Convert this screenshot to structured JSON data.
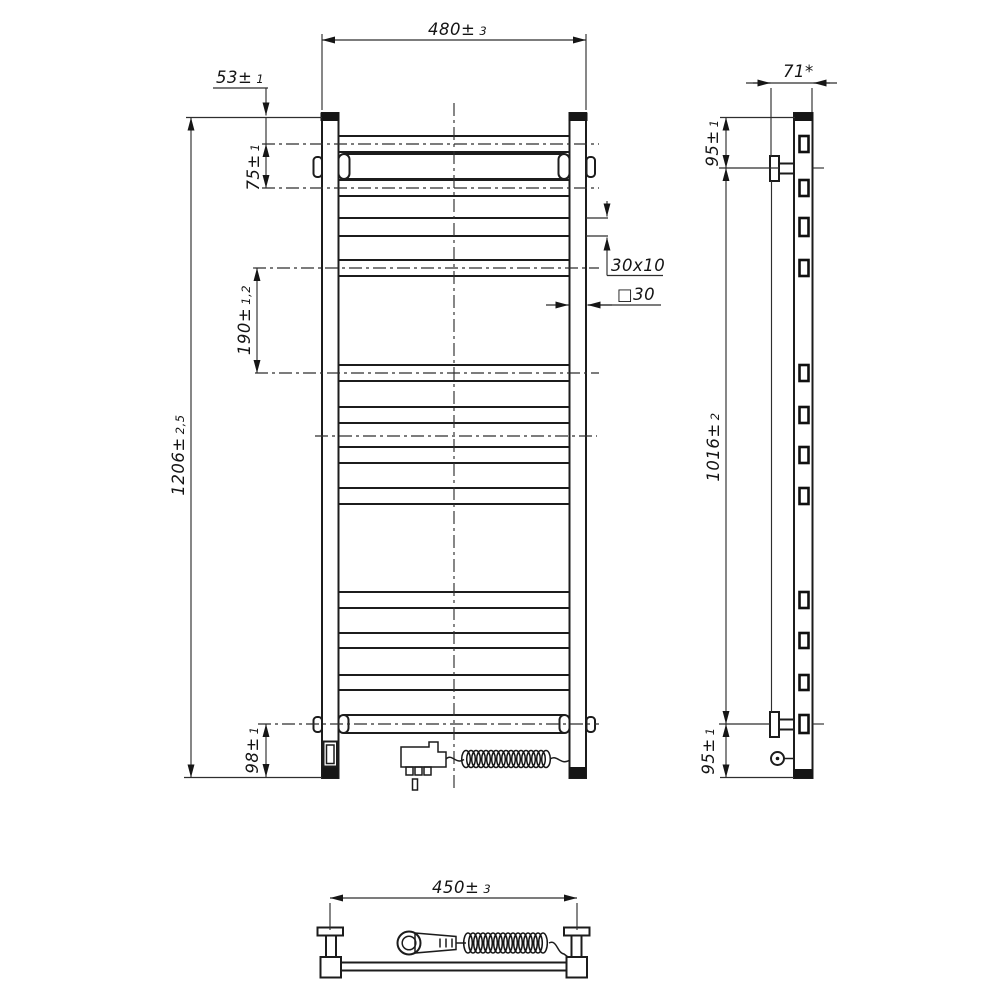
{
  "drawing": {
    "subject": "Electric heated towel rail — three-view technical drawing",
    "line_color": "#1c1c1c",
    "background": "#ffffff"
  },
  "dims": {
    "width_top": {
      "value": "480±",
      "tol": "3"
    },
    "top_offset": {
      "value": "53±",
      "tol": "1"
    },
    "top_pitch": {
      "value": "75±",
      "tol": "1"
    },
    "mid_pitch": {
      "value": "190±",
      "tol": "1,2"
    },
    "height": {
      "value": "1206±",
      "tol": "2,5"
    },
    "bottom_offset": {
      "value": "98±",
      "tol": "1"
    },
    "rung_section": {
      "value": "30x10"
    },
    "post_section": {
      "value": "□30"
    },
    "depth": {
      "value": "71*"
    },
    "side_top": {
      "value": "95±",
      "tol": "1"
    },
    "side_span": {
      "value": "1016±",
      "tol": "2"
    },
    "side_bottom": {
      "value": "95±",
      "tol": "1"
    },
    "bracket_width": {
      "value": "450±",
      "tol": "3"
    }
  },
  "front_view": {
    "rung_rows": [
      [
        136,
        152
      ],
      [
        180,
        196
      ],
      [
        218,
        236
      ],
      [
        260,
        276
      ],
      [
        365,
        381
      ],
      [
        407,
        423
      ],
      [
        447,
        463
      ],
      [
        488,
        504
      ],
      [
        592,
        608
      ],
      [
        633,
        648
      ],
      [
        675,
        690
      ]
    ],
    "tube_rows": [
      [
        154,
        179
      ],
      [
        715,
        733
      ]
    ],
    "side_slots_extra": [
      [
        715,
        733
      ]
    ],
    "centerlines": [
      [
        144,
        262,
        599
      ],
      [
        188,
        262,
        599
      ],
      [
        268,
        253,
        599
      ],
      [
        373,
        255,
        599
      ],
      [
        436,
        315,
        597
      ],
      [
        724,
        258,
        599
      ]
    ],
    "vertical_centerline": {
      "x": 454,
      "y1": 103,
      "y2": 792
    }
  }
}
